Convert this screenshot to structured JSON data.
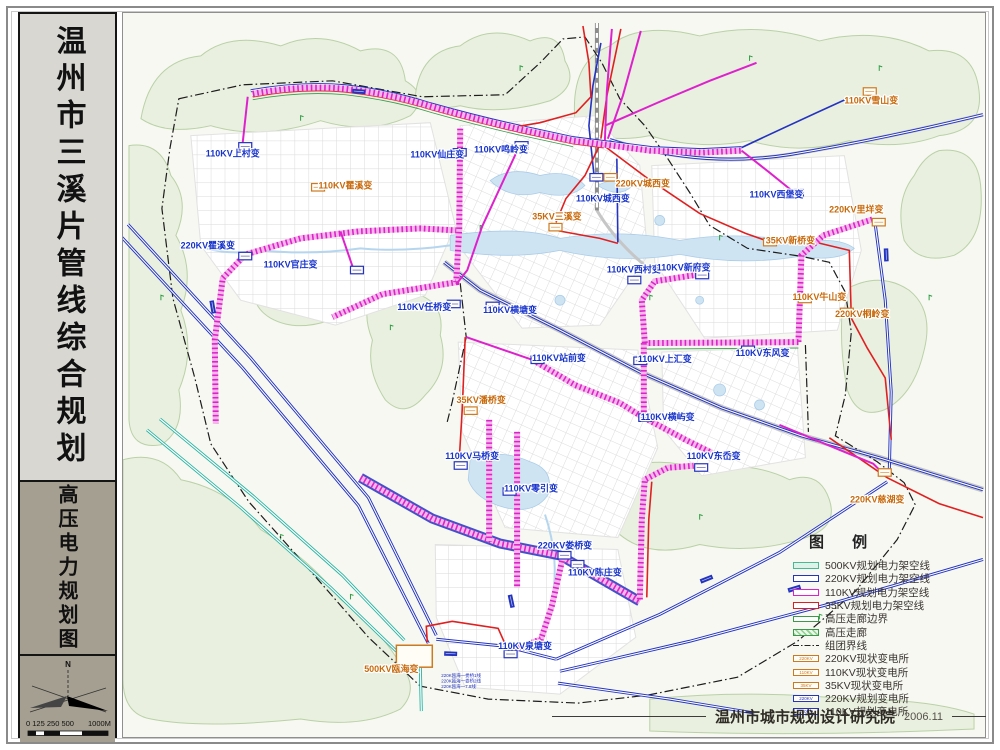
{
  "sidebar": {
    "title": "温州市三溪片管线综合规划",
    "subtitle": "高压电力规划图",
    "north_label": "N",
    "scale_label": "0 125 250 500",
    "scale_unit": "1000M"
  },
  "legend": {
    "title": "图  例",
    "items": [
      {
        "label": "500KV规划电力架空线",
        "type": "line-500"
      },
      {
        "label": "220KV规划电力架空线",
        "type": "line-220"
      },
      {
        "label": "110KV规划电力架空线",
        "type": "line-110"
      },
      {
        "label": "35KV规划电力架空线",
        "type": "line-35"
      },
      {
        "label": "高压走廊边界",
        "type": "corridor-edge"
      },
      {
        "label": "高压走廊",
        "type": "corridor"
      },
      {
        "label": "组团界线",
        "type": "cluster-line"
      },
      {
        "label": "220KV现状变电所",
        "type": "sub-existing",
        "tag": "220KV"
      },
      {
        "label": "110KV现状变电所",
        "type": "sub-existing",
        "tag": "110KV"
      },
      {
        "label": "35KV现状变电所",
        "type": "sub-existing",
        "tag": "35KV"
      },
      {
        "label": "220KV规划变电所",
        "type": "sub-planned",
        "tag": "220KV"
      },
      {
        "label": "110KV规划变电所",
        "type": "sub-planned",
        "tag": "110KV"
      }
    ]
  },
  "footer": {
    "org": "温州市城市规划设计研究院",
    "date": "2006.11"
  },
  "map": {
    "colors": {
      "kv500": "#28b3a2",
      "kv220": "#2433c0",
      "kv110": "#dd22cc",
      "kv35": "#e02020",
      "existing_label": "#c8690a",
      "planned_label": "#1733cc"
    },
    "stations": [
      {
        "text": "110KV上村变",
        "x": 232,
        "y": 156,
        "bx": 238,
        "by": 142,
        "status": "planned"
      },
      {
        "text": "110KV瞿溪变",
        "x": 345,
        "y": 188,
        "bx": 311,
        "by": 183,
        "status": "existing"
      },
      {
        "text": "220KV瞿溪变",
        "x": 207,
        "y": 248,
        "bx": 238,
        "by": 252,
        "status": "planned"
      },
      {
        "text": "110KV官庄变",
        "x": 290,
        "y": 267,
        "bx": 350,
        "by": 266,
        "status": "planned"
      },
      {
        "text": "110KV仙庄变",
        "x": 437,
        "y": 157,
        "bx": 453,
        "by": 148,
        "status": "planned"
      },
      {
        "text": "110KV鸣岭变",
        "x": 501,
        "y": 152,
        "bx": 515,
        "by": 141,
        "status": "planned"
      },
      {
        "text": "35KV三溪变",
        "x": 557,
        "y": 219,
        "bx": 549,
        "by": 223,
        "status": "existing"
      },
      {
        "text": "110KV城西变",
        "x": 603,
        "y": 201,
        "bx": 590,
        "by": 173,
        "status": "planned"
      },
      {
        "text": "220KV城西变",
        "x": 643,
        "y": 186,
        "bx": 604,
        "by": 173,
        "status": "existing"
      },
      {
        "text": "110KV雪山变",
        "x": 872,
        "y": 103,
        "bx": 864,
        "by": 87,
        "status": "existing"
      },
      {
        "text": "220KV里垟变",
        "x": 857,
        "y": 212,
        "bx": 873,
        "by": 218,
        "status": "existing"
      },
      {
        "text": "110KV西堡变",
        "x": 777,
        "y": 197,
        "bx": 791,
        "by": 189,
        "status": "planned"
      },
      {
        "text": "35KV新桥变",
        "x": 791,
        "y": 243,
        "bx": 764,
        "by": 238,
        "status": "existing"
      },
      {
        "text": "110KV西村变",
        "x": 634,
        "y": 272,
        "bx": 628,
        "by": 276,
        "status": "planned"
      },
      {
        "text": "110KV新府变",
        "x": 684,
        "y": 270,
        "bx": 696,
        "by": 271,
        "status": "planned"
      },
      {
        "text": "110KV牛山变",
        "x": 820,
        "y": 300,
        "bx": 799,
        "by": 295,
        "status": "existing"
      },
      {
        "text": "220KV桐岭变",
        "x": 863,
        "y": 317,
        "bx": 841,
        "by": 308,
        "status": "existing"
      },
      {
        "text": "110KV任桥变",
        "x": 424,
        "y": 310,
        "bx": 447,
        "by": 300,
        "status": "planned"
      },
      {
        "text": "110KV横塘变",
        "x": 510,
        "y": 313,
        "bx": 486,
        "by": 302,
        "status": "planned"
      },
      {
        "text": "110KV站前变",
        "x": 559,
        "y": 361,
        "bx": 531,
        "by": 356,
        "status": "planned"
      },
      {
        "text": "35KV潘桥变",
        "x": 481,
        "y": 403,
        "bx": 464,
        "by": 407,
        "status": "existing"
      },
      {
        "text": "110KV上汇变",
        "x": 665,
        "y": 362,
        "bx": 634,
        "by": 357,
        "status": "planned"
      },
      {
        "text": "110KV东风变",
        "x": 763,
        "y": 356,
        "bx": 742,
        "by": 346,
        "status": "planned"
      },
      {
        "text": "110KV横屿变",
        "x": 668,
        "y": 420,
        "bx": 639,
        "by": 414,
        "status": "planned"
      },
      {
        "text": "110KV东岙变",
        "x": 714,
        "y": 459,
        "bx": 695,
        "by": 464,
        "status": "planned"
      },
      {
        "text": "110KV马桥变",
        "x": 472,
        "y": 459,
        "bx": 454,
        "by": 462,
        "status": "planned"
      },
      {
        "text": "110KV零引变",
        "x": 531,
        "y": 492,
        "bx": 503,
        "by": 488,
        "status": "planned"
      },
      {
        "text": "220KV娄桥变",
        "x": 565,
        "y": 549,
        "bx": 558,
        "by": 552,
        "status": "planned"
      },
      {
        "text": "110KV陈庄变",
        "x": 595,
        "y": 576,
        "bx": 571,
        "by": 561,
        "status": "planned"
      },
      {
        "text": "500KV瓯海变",
        "x": 391,
        "y": 673,
        "bx": null,
        "by": null,
        "status": "existing"
      },
      {
        "text": "110KV泉塘变",
        "x": 525,
        "y": 650,
        "bx": 504,
        "by": 651,
        "status": "planned"
      },
      {
        "text": "220KV慈湖变",
        "x": 878,
        "y": 503,
        "bx": 879,
        "by": 469,
        "status": "existing"
      }
    ],
    "annotations": [
      "220K瓯海一娄桥1线",
      "220K瓯海一娄桥2线",
      "220K瓯海一7.8线"
    ]
  }
}
